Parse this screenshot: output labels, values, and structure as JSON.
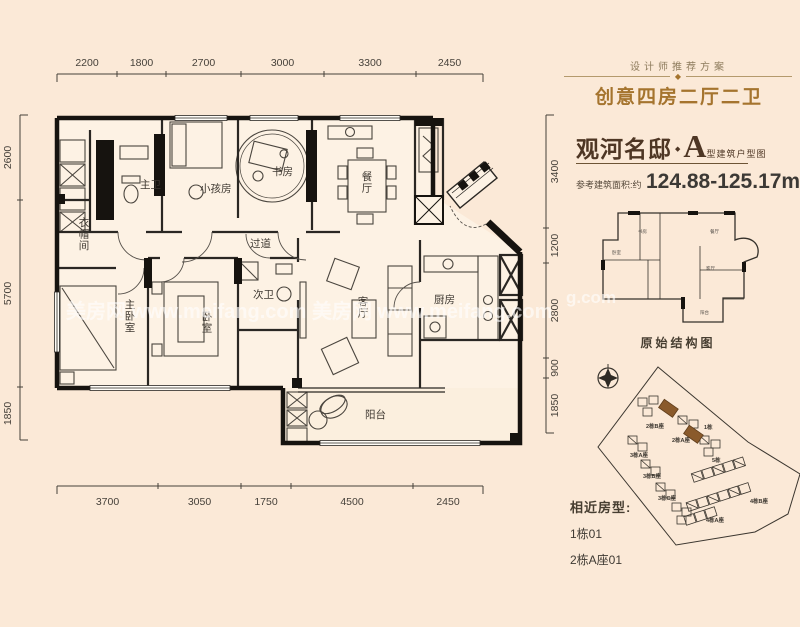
{
  "colors": {
    "background": "#fbe9d7",
    "wall": "#23201c",
    "accent_gold": "#a5742e",
    "title_brown": "#4e3624",
    "dim_text": "#46413a",
    "highlight_building": "#8a5a2b"
  },
  "header": {
    "tagline": "设计师推荐方案",
    "ornament": "◆",
    "title": "创意四房二厅二卫",
    "project_name": "观河名邸",
    "separator": "◆",
    "unit_letter": "A",
    "unit_suffix": "型建筑户型图",
    "area_label": "参考建筑面积:约",
    "area_value": "124.88-125.17m",
    "area_sup": "2"
  },
  "floorplan": {
    "rooms": [
      {
        "id": "master-bath",
        "label": "主卫",
        "x": 140,
        "y": 188,
        "vertical": false
      },
      {
        "id": "kids-room",
        "label": "小孩房",
        "x": 200,
        "y": 192,
        "vertical": false
      },
      {
        "id": "study",
        "label": "书房",
        "x": 272,
        "y": 175,
        "vertical": false
      },
      {
        "id": "dining",
        "label": "餐厅",
        "x": 367,
        "y": 180,
        "vertical": true
      },
      {
        "id": "corridor",
        "label": "过道",
        "x": 250,
        "y": 247,
        "vertical": false
      },
      {
        "id": "cloakroom",
        "label": "衣帽间",
        "x": 84,
        "y": 226,
        "vertical": true
      },
      {
        "id": "master-bedroom",
        "label": "主卧室",
        "x": 130,
        "y": 308,
        "vertical": true
      },
      {
        "id": "bedroom",
        "label": "卧室",
        "x": 207,
        "y": 320,
        "vertical": true
      },
      {
        "id": "second-bath",
        "label": "次卫",
        "x": 253,
        "y": 298,
        "vertical": false
      },
      {
        "id": "living-room",
        "label": "客厅",
        "x": 363,
        "y": 305,
        "vertical": true
      },
      {
        "id": "kitchen",
        "label": "厨房",
        "x": 434,
        "y": 303,
        "vertical": false
      },
      {
        "id": "balcony",
        "label": "阳台",
        "x": 365,
        "y": 418,
        "vertical": false
      }
    ],
    "dimensions": {
      "top": {
        "labels": [
          "2200",
          "1800",
          "2700",
          "3000",
          "3300",
          "2450"
        ],
        "ticks": [
          57,
          117,
          166,
          241,
          324,
          416,
          483
        ],
        "line_y": 74,
        "label_y": 66
      },
      "bottom": {
        "labels": [
          "3700",
          "3050",
          "1750",
          "4500",
          "2450"
        ],
        "ticks": [
          57,
          158,
          241,
          291,
          413,
          483
        ],
        "line_y": 486,
        "label_y": 505
      },
      "left": {
        "labels": [
          "2600",
          "5700",
          "1850"
        ],
        "ticks": [
          115,
          200,
          387,
          440
        ],
        "line_x": 20,
        "label_x": 11
      },
      "right": {
        "labels": [
          "3400",
          "1200",
          "2800",
          "900",
          "1850"
        ],
        "ticks": [
          115,
          228,
          263,
          358,
          378,
          433
        ],
        "line_x": 546,
        "label_x": 558
      }
    }
  },
  "structure_diagram": {
    "caption": "原始结构图",
    "mini_labels": [
      {
        "label": "卧室",
        "x": 612,
        "y": 254
      },
      {
        "label": "书房",
        "x": 638,
        "y": 233
      },
      {
        "label": "餐厅",
        "x": 710,
        "y": 233
      },
      {
        "label": "客厅",
        "x": 706,
        "y": 270
      },
      {
        "label": "阳台",
        "x": 700,
        "y": 314
      }
    ]
  },
  "siteplan": {
    "building_labels": [
      {
        "label": "2栋B座",
        "x": 646,
        "y": 428
      },
      {
        "label": "2栋A座",
        "x": 672,
        "y": 442
      },
      {
        "label": "1栋",
        "x": 704,
        "y": 429
      },
      {
        "label": "3栋A座",
        "x": 630,
        "y": 457
      },
      {
        "label": "3栋B座",
        "x": 643,
        "y": 478
      },
      {
        "label": "3栋C座",
        "x": 658,
        "y": 500
      },
      {
        "label": "5栋",
        "x": 712,
        "y": 462
      },
      {
        "label": "4栋B座",
        "x": 750,
        "y": 503
      },
      {
        "label": "4栋A座",
        "x": 706,
        "y": 522
      }
    ]
  },
  "similar": {
    "label": "相近房型:",
    "items": [
      "1栋01",
      "2栋A座01"
    ]
  },
  "watermarks": [
    {
      "text": "美房网 www.meifang.com 美房网 www.meifang.com",
      "x": 66,
      "y": 318,
      "size": 20
    },
    {
      "text": "g.com",
      "x": 566,
      "y": 303,
      "size": 17
    }
  ]
}
